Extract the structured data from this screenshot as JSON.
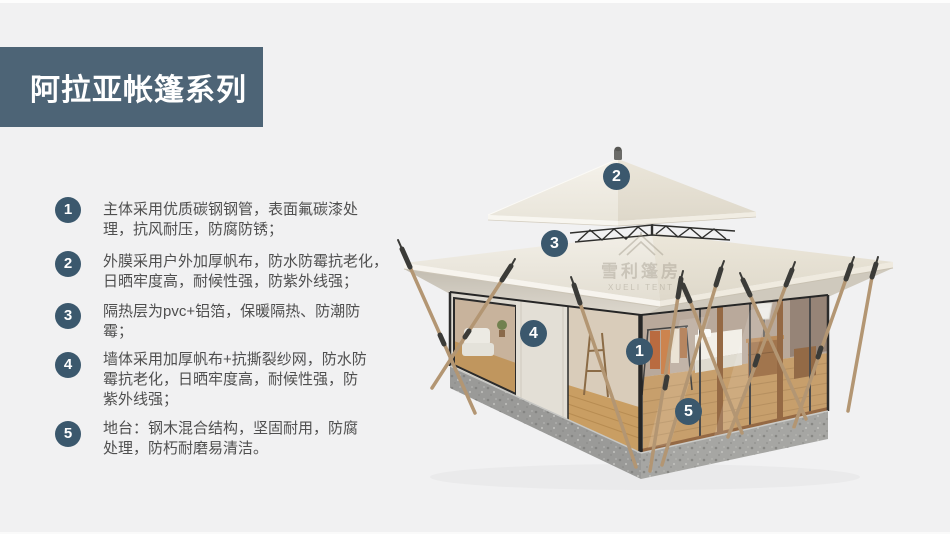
{
  "slide": {
    "title": "阿拉亚帐篷系列",
    "background_color": "#f1f1f2",
    "banner_color": "#4d6476",
    "badge_color": "#3b586d",
    "text_color": "#4f4f4f"
  },
  "features": {
    "items": [
      {
        "num": "1",
        "lines": [
          "主体采用优质碳钢钢管，表面氟碳漆处",
          "理，抗风耐压，防腐防锈；"
        ]
      },
      {
        "num": "2",
        "lines": [
          "外膜采用户外加厚帆布，防水防霉抗老化，",
          "日晒牢度高，耐候性强，防紫外线强；"
        ]
      },
      {
        "num": "3",
        "lines": [
          "隔热层为pvc+铝箔，保暖隔热、防潮防",
          "霉；"
        ]
      },
      {
        "num": "4",
        "lines": [
          "墙体采用加厚帆布+抗撕裂纱网，防水防",
          "霉抗老化，日晒牢度高，耐候性强，防",
          "紫外线强；"
        ]
      },
      {
        "num": "5",
        "lines": [
          "地台：钢木混合结构，坚固耐用，防腐",
          "处理，防朽耐磨易清洁。"
        ]
      }
    ]
  },
  "illustration": {
    "subject": "双层亭顶野奢帐篷",
    "callouts": [
      {
        "num": "2"
      },
      {
        "num": "3"
      },
      {
        "num": "4"
      },
      {
        "num": "1"
      },
      {
        "num": "5"
      }
    ],
    "watermark": {
      "icon": "pavilion-tent-icon",
      "cn": "雪利篷房",
      "en": "XUELI TENT"
    }
  }
}
